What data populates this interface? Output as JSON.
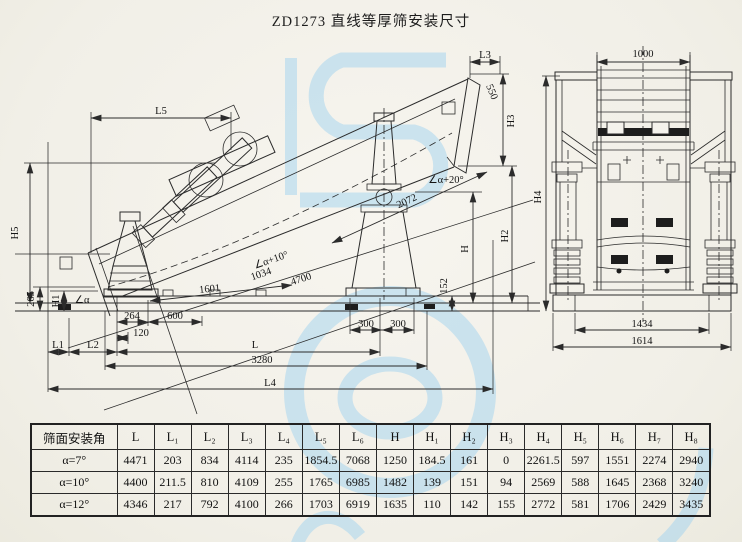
{
  "title": "ZD1273 直线等厚筛安装尺寸",
  "side_view": {
    "dims": {
      "L5": "L5",
      "H5": "H5",
      "n265": "265",
      "H1": "H1",
      "alpha": "∠α",
      "L1": "L1",
      "L2": "L2",
      "n264": "264",
      "n120": "120",
      "n600": "600",
      "n1601": "1601",
      "alpha10": "∠α+10°",
      "n1034": "1034",
      "n4700": "4700",
      "n2072": "2072",
      "alpha20": "∠α+20°",
      "n152": "152",
      "n300a": "300",
      "n300b": "300",
      "L": "L",
      "n3280": "3280",
      "L4": "L4",
      "H": "H",
      "H2": "H2",
      "H3": "H3",
      "n550": "550",
      "L3": "L3"
    }
  },
  "end_view": {
    "dims": {
      "n1000": "1000",
      "H4": "H4",
      "n1434": "1434",
      "n1614": "1614"
    }
  },
  "table": {
    "corner_header": "筛面安装角",
    "columns": [
      "L",
      "L₁",
      "L₂",
      "L₃",
      "L₄",
      "L₅",
      "L₆",
      "H",
      "H₁",
      "H₂",
      "H₃",
      "H₄",
      "H₅",
      "H₆",
      "H₇",
      "H₈"
    ],
    "rows": [
      {
        "angle": "α=7°",
        "values": [
          "4471",
          "203",
          "834",
          "4114",
          "235",
          "1854.5",
          "7068",
          "1250",
          "184.5",
          "161",
          "0",
          "2261.5",
          "597",
          "1551",
          "2274",
          "2940"
        ]
      },
      {
        "angle": "α=10°",
        "values": [
          "4400",
          "211.5",
          "810",
          "4109",
          "255",
          "1765",
          "6985",
          "1482",
          "139",
          "151",
          "94",
          "2569",
          "588",
          "1645",
          "2368",
          "3240"
        ]
      },
      {
        "angle": "α=12°",
        "values": [
          "4346",
          "217",
          "792",
          "4100",
          "266",
          "1703",
          "6919",
          "1635",
          "110",
          "142",
          "155",
          "2772",
          "581",
          "1706",
          "2429",
          "3435"
        ]
      }
    ]
  }
}
